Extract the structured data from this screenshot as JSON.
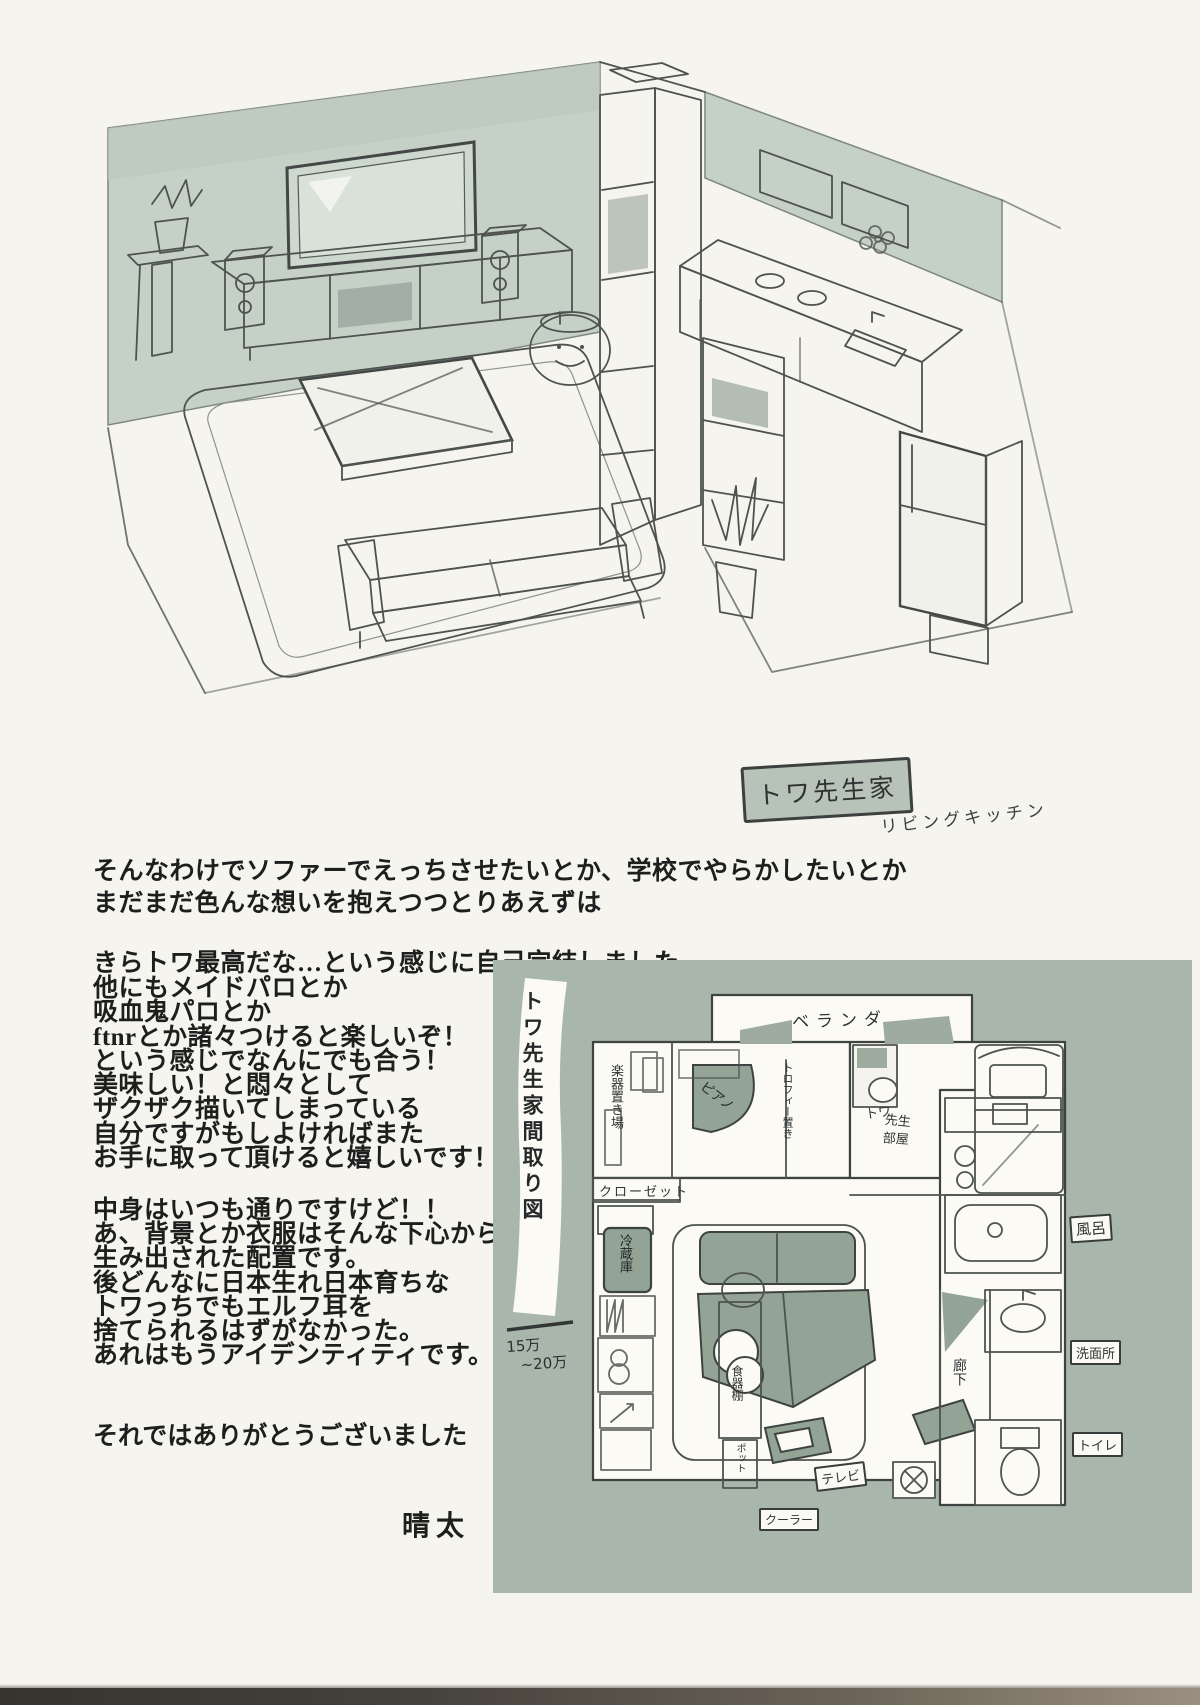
{
  "page": {
    "bg": "#f6f4ee",
    "panel_color": "#a9b6ac",
    "ink_color": "#1d1f1f",
    "pencil_color": "#4e534f"
  },
  "sketch": {
    "caption": "トワ先生家",
    "subcaption": "リビングキッチン"
  },
  "afterword": {
    "para1": [
      "そんなわけでソファーでえっちさせたいとか、学校でやらかしたいとか",
      "まだまだ色んな想いを抱えつつとりあえずは"
    ],
    "para2": [
      "きらトワ最高だな…という感じに自己完結しました。"
    ],
    "para3": [
      "他にもメイドパロとか",
      "吸血鬼パロとか",
      "ftnrとか諸々つけると楽しいぞ！",
      "という感じでなんにでも合う！",
      "美味しい！と悶々として",
      "ザクザク描いてしまっている",
      "自分ですがもしよければまた",
      "お手に取って頂けると嬉しいです！"
    ],
    "para4": [
      "中身はいつも通りですけど！！",
      "あ、背景とか衣服はそんな下心から",
      "生み出された配置です。",
      "後どんなに日本生れ日本育ちな",
      "トワっちでもエルフ耳を",
      "捨てられるはずがなかった。",
      "あれはもうアイデンティティです。"
    ],
    "closing": "それではありがとうございました",
    "signature": "晴太"
  },
  "floorplan": {
    "side_label": "トワ先生家間取り図",
    "rent_line1": "15万",
    "rent_line2": "~20万",
    "labels": {
      "balcony": "ベランダ",
      "instrument_storage": "楽器置き場",
      "piano": "ピアノ",
      "trophy_shelf": "トロフィー置き",
      "towa_room_1": "トワ",
      "towa_room_2": "先生",
      "towa_room_3": "部屋",
      "closet": "クローゼット",
      "fridge": "冷蔵庫",
      "dish_cabinet": "食器棚",
      "pot": "ポット",
      "tv": "テレビ",
      "aircon": "クーラー",
      "hallway": "廊下",
      "bath": "風呂",
      "washroom": "洗面所",
      "toilet": "トイレ"
    }
  }
}
